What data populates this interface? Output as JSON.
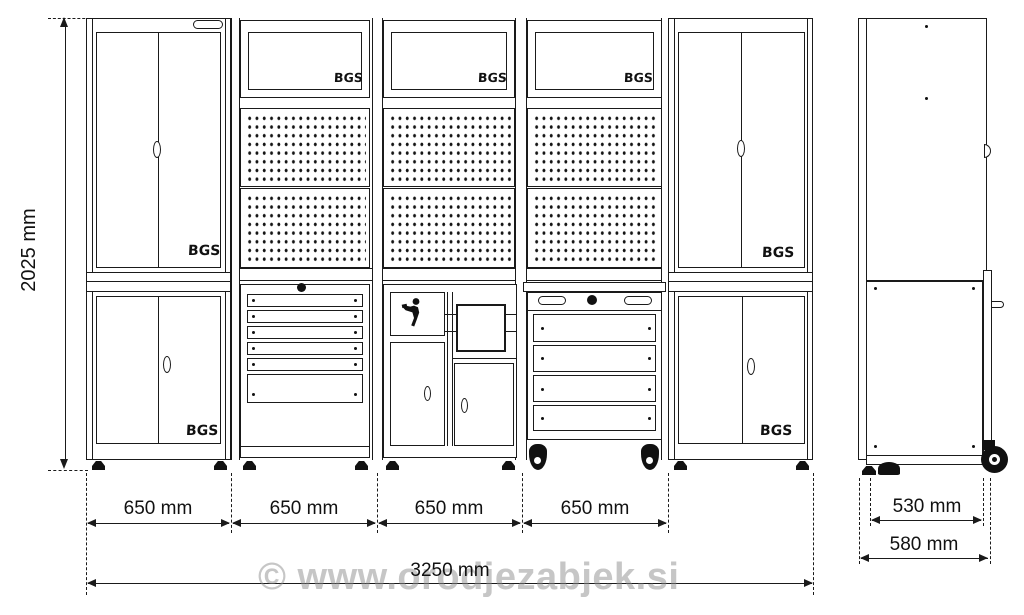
{
  "drawing": {
    "title": "Workshop cabinet wall system — dimensional drawing",
    "brand": "BGS",
    "watermark": "© www.orodjezabjek.si"
  },
  "dimensions": {
    "height": "2025 mm",
    "segments": [
      "650 mm",
      "650 mm",
      "650 mm",
      "650 mm"
    ],
    "total_width": "3250 mm",
    "cabinet_depth": "530 mm",
    "overall_depth": "580 mm"
  },
  "front_view": {
    "modules": [
      {
        "name": "tall-cabinet-left"
      },
      {
        "name": "drawer-base-with-pegboard"
      },
      {
        "name": "utility-base-with-pegboard"
      },
      {
        "name": "roller-cabinet-with-pegboard"
      },
      {
        "name": "tall-cabinet-right"
      }
    ]
  },
  "side_view": {
    "name": "side-profile"
  },
  "colors": {
    "line": "#1a1a1a",
    "background": "#ffffff",
    "watermark": "#8f8f8f",
    "black_fill": "#111111"
  }
}
